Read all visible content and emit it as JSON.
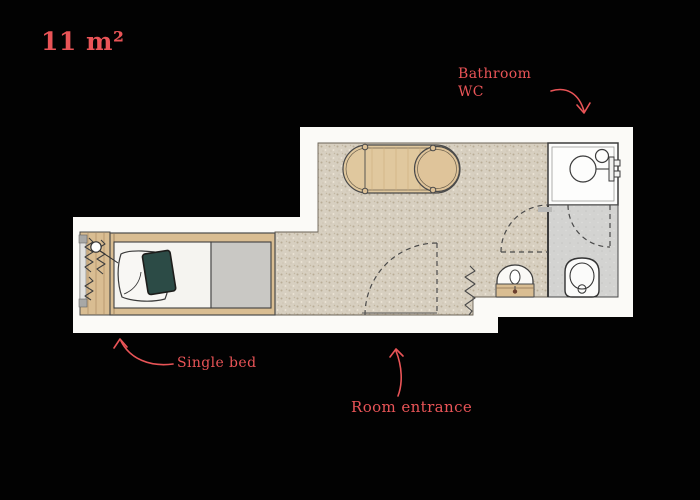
{
  "title": "11 m²",
  "annotations": {
    "bathroom_line1": "Bathroom",
    "bathroom_line2": "WC",
    "single_bed": "Single bed",
    "room_entrance": "Room entrance"
  },
  "colors": {
    "accent": "#e95457",
    "background": "#020202",
    "wall_white": "#fbfaf7",
    "carpet": "#d7cfc0",
    "wood": "#dcc096",
    "bathroom_floor_gray": "#d3d3d1",
    "blanket_gray": "#c9c8c4",
    "mattress_white": "#f5f4f0",
    "cushion_teal": "#2c4b46",
    "linework": "#434039"
  },
  "icons": {
    "bed": "single-bed-plan-symbol",
    "table": "oval-table-with-stool",
    "shower": "shower-with-mixer",
    "washbasin": "arched-washbasin",
    "toilet": "toilet-plan-symbol",
    "radiator": "spring-zigzag-symbol",
    "doors": "dashed-door-swing"
  }
}
